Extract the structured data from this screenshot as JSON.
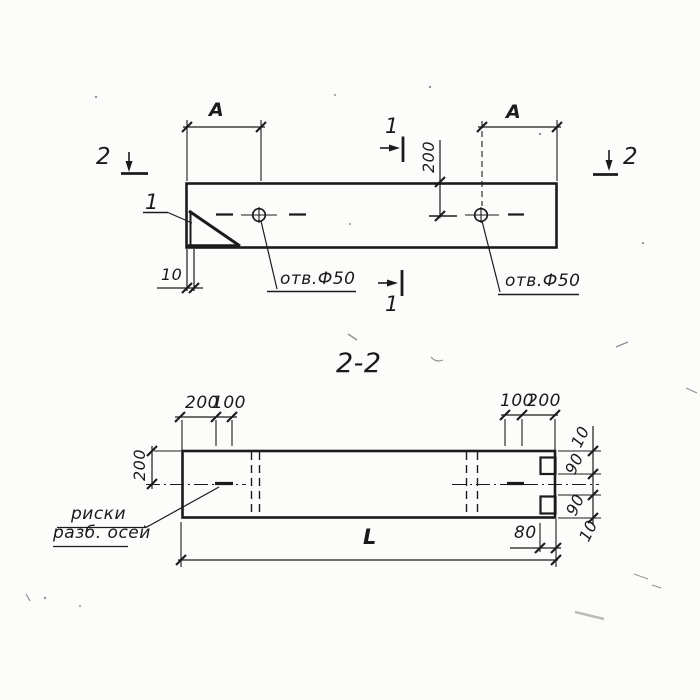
{
  "plan": {
    "span_label_left": "A",
    "span_label_right": "A",
    "edge_to_hole_dim": "200",
    "corner_offset_dim": "10",
    "hole_note_left": "отв.Ф50",
    "hole_note_right": "отв.Ф50",
    "section1_mark": "1",
    "section2_mark": "2",
    "detail_mark": "1"
  },
  "section_view": {
    "title": "2-2",
    "top_left_dims": [
      "200",
      "100"
    ],
    "top_right_dims": [
      "100",
      "200"
    ],
    "height_dim": "200",
    "right_edge_dims": [
      "10",
      "90",
      "90",
      "10"
    ],
    "notch_depth_dim": "80",
    "length_label": "L",
    "axis_note_line1": "риски",
    "axis_note_line2": "разб. осей"
  },
  "colors": {
    "ink": "#1b1b1b",
    "paper": "#fcfcfa"
  }
}
